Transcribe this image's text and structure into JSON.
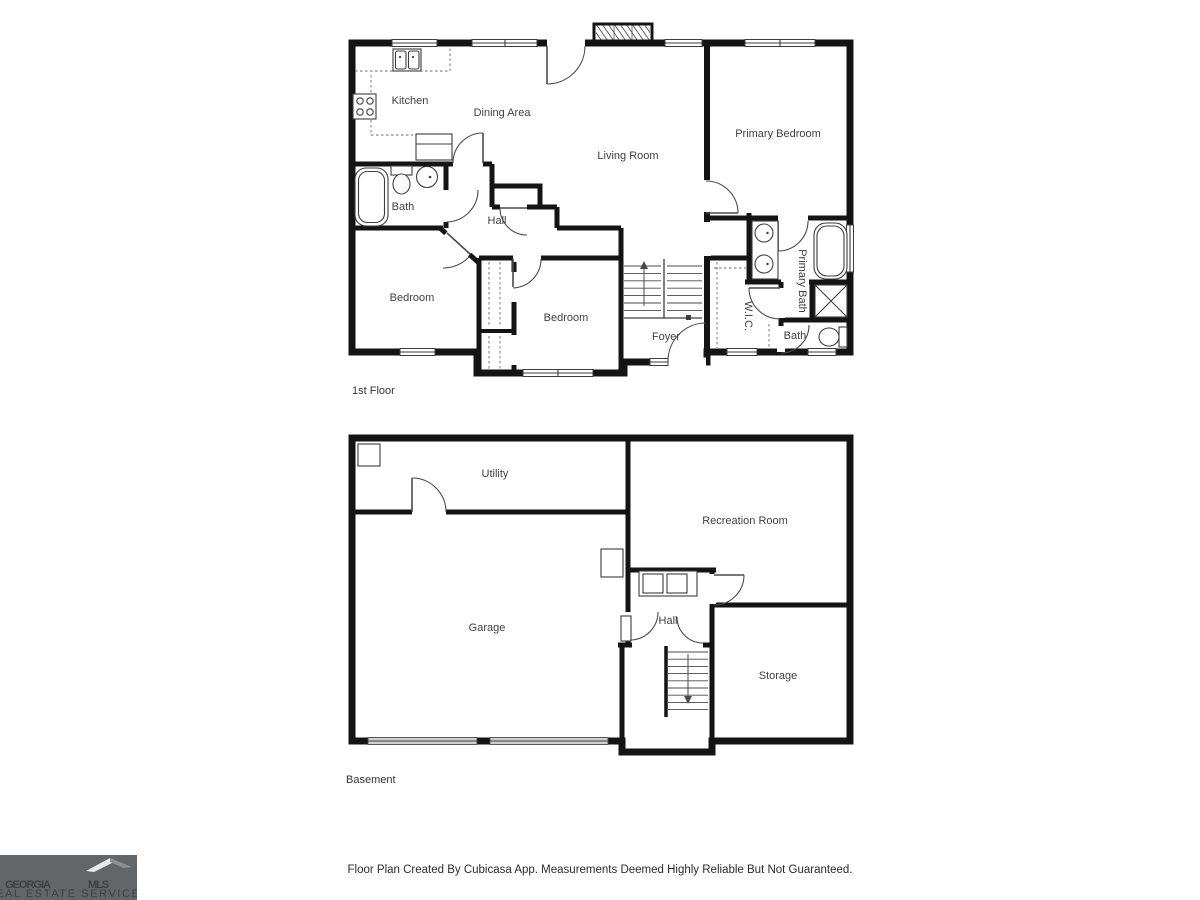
{
  "first_floor": {
    "title": "1st Floor",
    "rooms": {
      "kitchen": "Kitchen",
      "dining": "Dining Area",
      "living": "Living Room",
      "primary_bedroom": "Primary Bedroom",
      "bath": "Bath",
      "hall": "Hall",
      "bedroom_left": "Bedroom",
      "bedroom_middle": "Bedroom",
      "foyer": "Foyer",
      "wic": "W.I.C.",
      "primary_bath": "Primary Bath",
      "bath2": "Bath"
    }
  },
  "basement": {
    "title": "Basement",
    "rooms": {
      "utility": "Utility",
      "recreation": "Recreation Room",
      "garage": "Garage",
      "hall": "Hall",
      "storage": "Storage"
    }
  },
  "footer": {
    "disclaimer": "Floor Plan Created By Cubicasa App. Measurements Deemed Highly Reliable But Not Guaranteed."
  },
  "logo": {
    "brand_primary": "GEORGIA",
    "brand_secondary": "MLS",
    "tagline": "REAL ESTATE SERVICES"
  },
  "colors": {
    "wall": "#141414",
    "line": "#3d3d3d",
    "label": "#3f3f3f",
    "logo_bg": "#636668",
    "logo_primary": "#f5f5f5",
    "logo_secondary": "#97999c"
  }
}
